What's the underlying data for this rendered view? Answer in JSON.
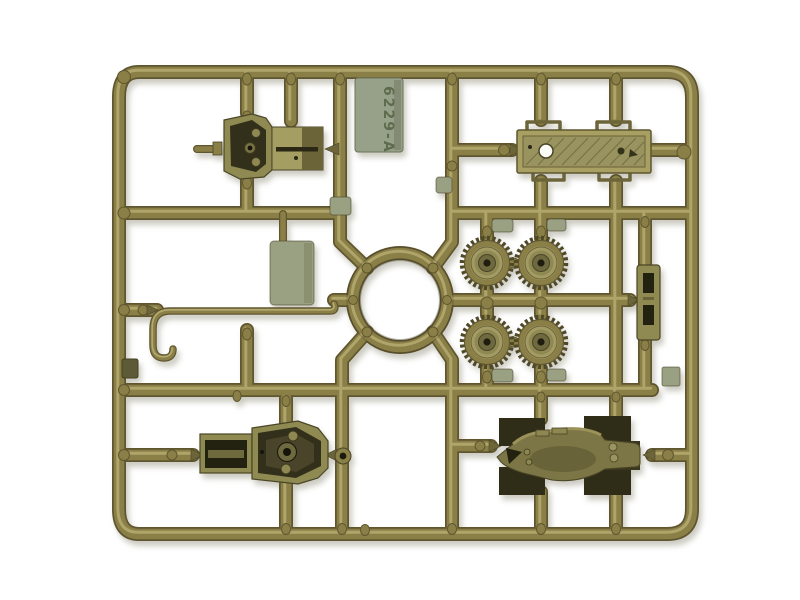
{
  "scene": {
    "description": "Olive-green injection-molded plastic model kit sprue photographed on a white background",
    "label_tag": {
      "text": "6229-A"
    },
    "colors": {
      "background": "#ffffff",
      "plastic": "#8a7f46",
      "plastic_light": "#b8ae72",
      "plastic_dark": "#5f5630",
      "face_dark": "#32301a",
      "pad_gray": "#9aa183",
      "tag_fill": "#97a189",
      "tag_text": "#5e6b4d",
      "shadow": "rgba(110,105,80,0.35)"
    },
    "parts": [
      {
        "id": "gun-mount",
        "label": "gun mount shield with barrel and mantlet slab"
      },
      {
        "id": "label-tag",
        "label": "mold number tag 6229-A"
      },
      {
        "id": "chassis-plate",
        "label": "flat chassis plate with holes and brackets"
      },
      {
        "id": "road-wheels",
        "label": "four toothed road wheels"
      },
      {
        "id": "turret-ring",
        "label": "central turret ring"
      },
      {
        "id": "side-panel",
        "label": "rectangular side panel"
      },
      {
        "id": "tow-hook-rod",
        "label": "bent wire tow hook rod"
      },
      {
        "id": "eyelet",
        "label": "small eyelet with hole"
      },
      {
        "id": "slotted-bracket",
        "label": "slotted bracket rail"
      },
      {
        "id": "turret-base",
        "label": "turret base with rear tray"
      },
      {
        "id": "hull-top",
        "label": "boat-shaped hull top with fenders"
      }
    ]
  }
}
